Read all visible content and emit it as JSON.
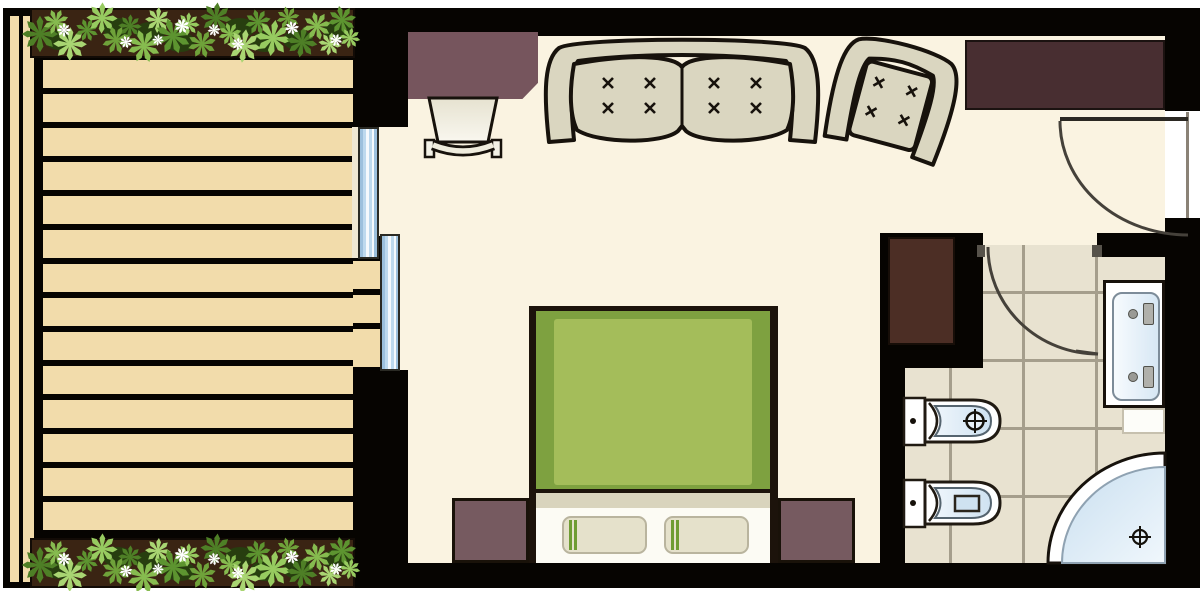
{
  "document": {
    "title": "Hotel room floor plan",
    "view": "top-down architectural plan",
    "visible_text": "none"
  },
  "areas": [
    {
      "id": "terrace",
      "label": "Terrace with wooden deck and two planters of shrubs"
    },
    {
      "id": "bedroom",
      "label": "Main bedroom / living area"
    },
    {
      "id": "bathroom",
      "label": "Bathroom with tiled floor"
    },
    {
      "id": "entry",
      "label": "Entry corridor with entrance door"
    }
  ],
  "furniture": [
    {
      "id": "desk",
      "label": "Desk with clipped corner",
      "color": "#76555d"
    },
    {
      "id": "desk-chair",
      "label": "Desk chair",
      "color": "#e9e5d4"
    },
    {
      "id": "sofa",
      "label": "Two-seat sofa with tufted cushions",
      "cushions": 2,
      "tufts_per_cushion": 4
    },
    {
      "id": "armchair",
      "label": "Armchair, rotated",
      "tufts": 4
    },
    {
      "id": "wardrobe",
      "label": "Wardrobe against top wall",
      "color": "#482e31"
    },
    {
      "id": "closet",
      "label": "Closet beside bathroom",
      "color": "#4c2e25"
    },
    {
      "id": "bed",
      "label": "Double bed with green duvet and two pillows",
      "pillows": 2,
      "duvet_color": "#a4bd5a"
    },
    {
      "id": "nightstand-left",
      "label": "Left nightstand",
      "color": "#765a60"
    },
    {
      "id": "nightstand-right",
      "label": "Right nightstand",
      "color": "#765a60"
    }
  ],
  "fixtures": [
    {
      "id": "vanity",
      "label": "Vanity with double-length basin and two faucets"
    },
    {
      "id": "bidet",
      "label": "Bidet with drain symbol"
    },
    {
      "id": "toilet",
      "label": "Toilet with cistern symbol"
    },
    {
      "id": "bathtub",
      "label": "Corner bathtub with drain symbol"
    },
    {
      "id": "sliding-window",
      "label": "Sliding glass door to terrace",
      "panels": 2
    },
    {
      "id": "entrance-door",
      "label": "Entrance door with swing arc"
    },
    {
      "id": "bathroom-door",
      "label": "Bathroom door swing arc"
    }
  ],
  "terrace": {
    "deck_planks": 14,
    "plank_color": "#f2dcab",
    "planters": 2
  },
  "colors": {
    "wall": "#060401",
    "room_floor": "#faf3e1",
    "deck": "#f2dcab",
    "tile": "#e8e2d0",
    "grout": "#a59e8c",
    "duvet_green": "#a4bd5a",
    "duvet_border_green": "#7ea140",
    "upholstery": "#dad6c0",
    "fixture_blue": "#d7e7f4",
    "window_blue": "#bdd9ee",
    "mauve_furniture": "#76555d",
    "dark_wood": "#482e31",
    "plant_green": "#86bb4f"
  }
}
